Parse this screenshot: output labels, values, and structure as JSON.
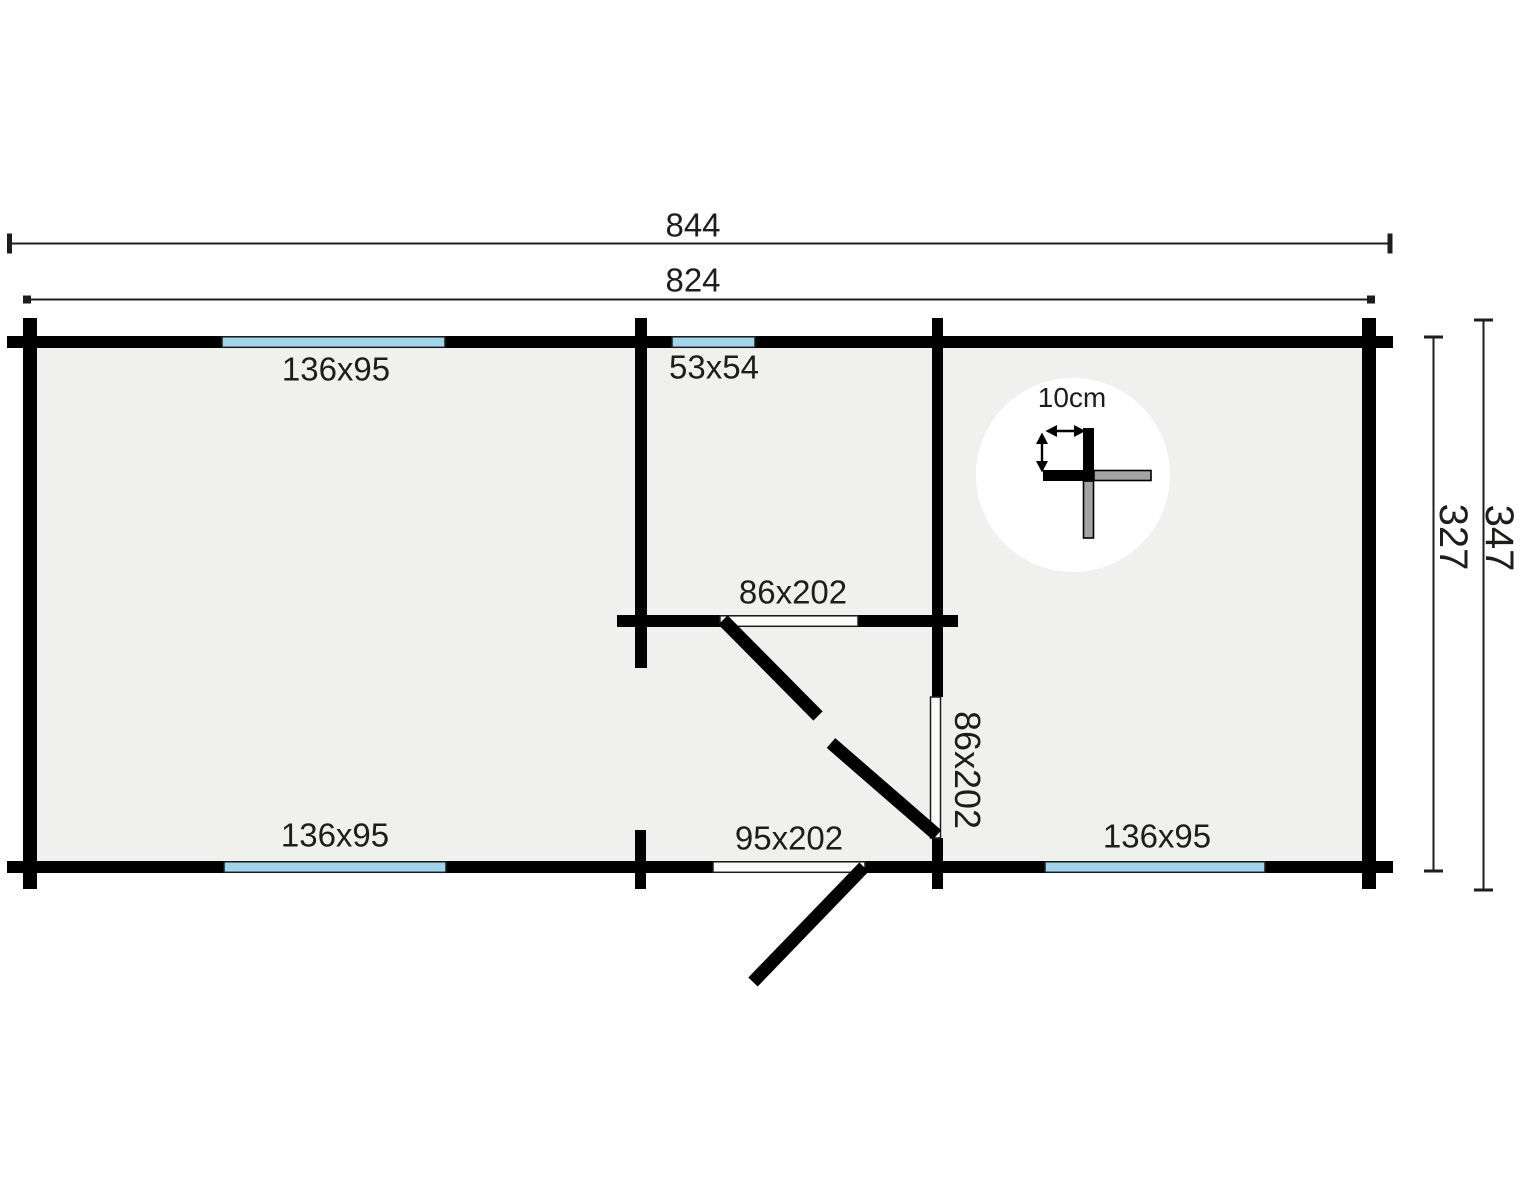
{
  "plan": {
    "dimensions": {
      "outer_width": "844",
      "inner_width": "824",
      "outer_depth": "347",
      "inner_depth": "327"
    },
    "windows": [
      {
        "id": "top-left",
        "label": "136x95"
      },
      {
        "id": "top-middle",
        "label": "53x54"
      },
      {
        "id": "bottom-left",
        "label": "136x95"
      },
      {
        "id": "bottom-right",
        "label": "136x95"
      }
    ],
    "doors": [
      {
        "id": "interior-hall",
        "label": "86x202"
      },
      {
        "id": "interior-side",
        "label": "86x202"
      },
      {
        "id": "entrance",
        "label": "95x202"
      }
    ],
    "detail": {
      "wall_thickness": "10cm"
    },
    "colors": {
      "wall": "#000000",
      "floor": "#f0f0ef",
      "window": "#a2d5ec",
      "door_leaf": "#fbfbfa",
      "detail_gray": "#a3a3a3",
      "line": "#1d1d1b",
      "background": "#ffffff"
    }
  }
}
